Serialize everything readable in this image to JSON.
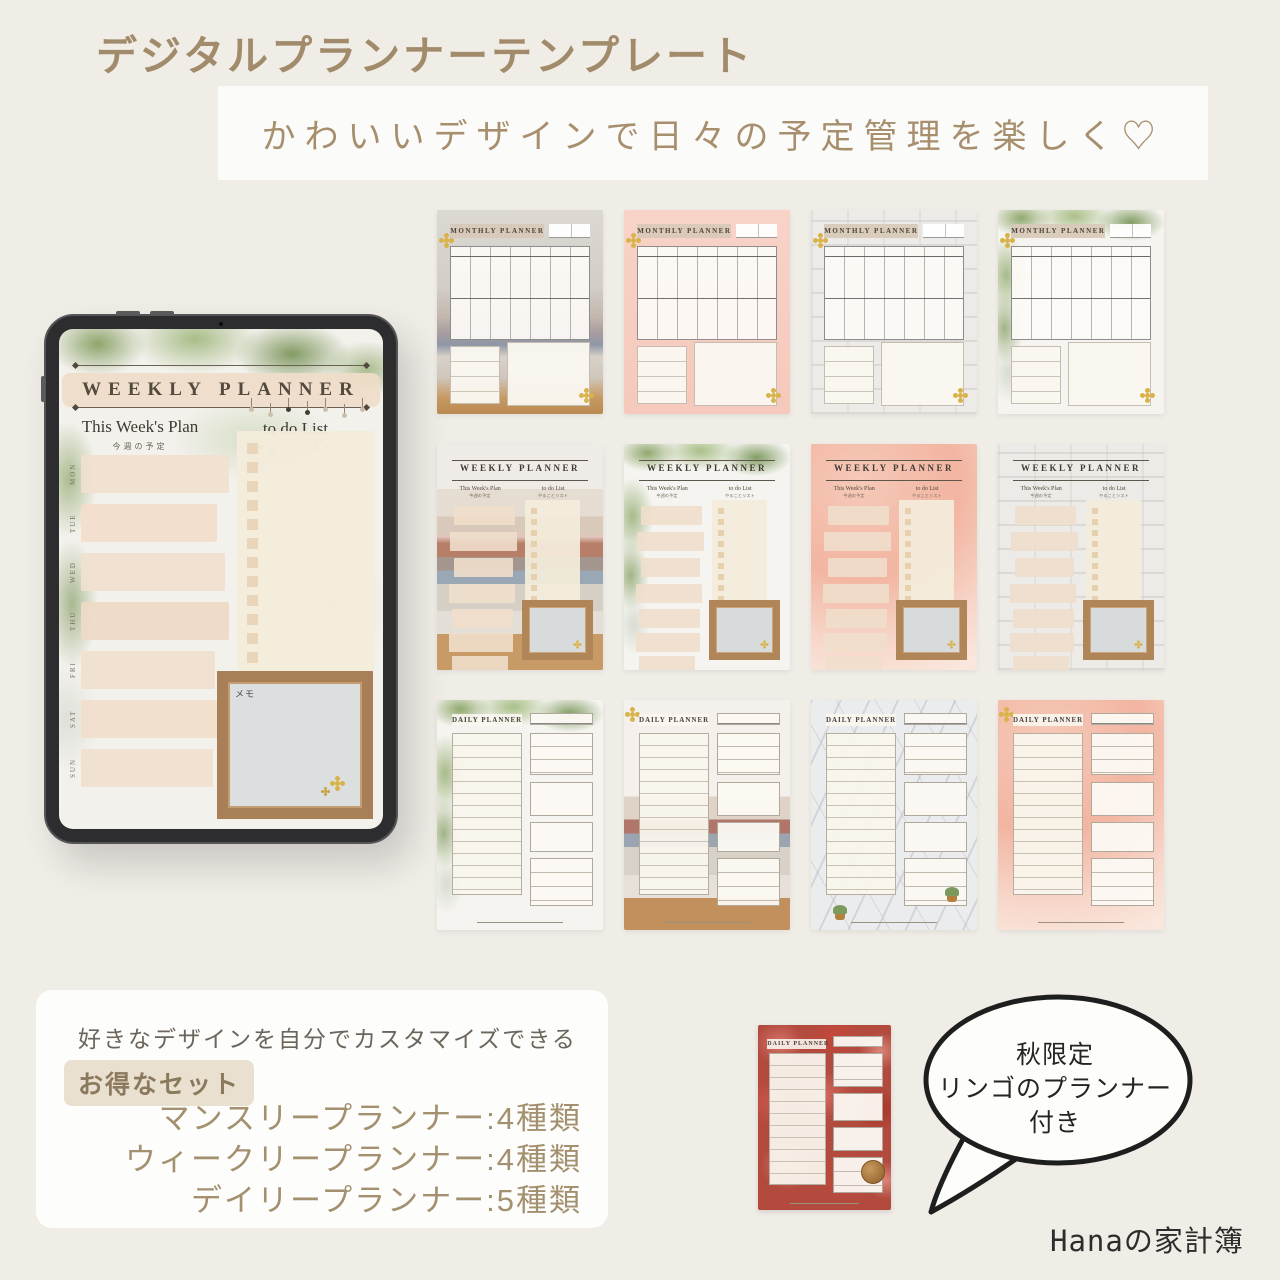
{
  "page": {
    "title": "デジタルプランナーテンプレート",
    "banner": "かわいいデザインで日々の予定管理を楽しく♡",
    "credit": "Hanaの家計簿",
    "colors": {
      "background": "#f0ede7",
      "accent_text": "#a18b6b",
      "banner_bg": "#fbfbf9",
      "beige_box": "#efdecb",
      "wood_frame": "#a97f57",
      "dark_text": "#2d2d2d"
    }
  },
  "labels": {
    "weekly_title": "WEEKLY PLANNER",
    "monthly_title": "MONTHLY PLANNER",
    "daily_title": "DAILY PLANNER",
    "this_weeks_plan": "This Week's Plan",
    "this_weeks_plan_jp": "今週の予定",
    "todo_list": "to do List",
    "todo_list_jp": "やることリスト",
    "memo": "メモ"
  },
  "tablet": {
    "days": [
      "MON",
      "TUE",
      "WED",
      "THU",
      "FRI",
      "SAT",
      "SUN"
    ]
  },
  "grid": {
    "items": [
      {
        "title": "MONTHLY PLANNER",
        "style": "photo-blankets"
      },
      {
        "title": "MONTHLY PLANNER",
        "style": "pink"
      },
      {
        "title": "MONTHLY PLANNER",
        "style": "white-brick"
      },
      {
        "title": "MONTHLY PLANNER",
        "style": "greenery"
      },
      {
        "title": "WEEKLY PLANNER",
        "style": "blanket-stack"
      },
      {
        "title": "WEEKLY PLANNER",
        "style": "greenery"
      },
      {
        "title": "WEEKLY PLANNER",
        "style": "pink-watercolor"
      },
      {
        "title": "WEEKLY PLANNER",
        "style": "white-brick"
      },
      {
        "title": "DAILY PLANNER",
        "style": "greenery"
      },
      {
        "title": "DAILY PLANNER",
        "style": "flowers-blanket"
      },
      {
        "title": "DAILY PLANNER",
        "style": "marble-plants"
      },
      {
        "title": "DAILY PLANNER",
        "style": "pink-watercolor"
      }
    ]
  },
  "info_box": {
    "line1": "好きなデザインを自分でカスタマイズできる",
    "badge": "お得なセット",
    "items": [
      "マンスリープランナー:4種類",
      "ウィークリープランナー:4種類",
      "デイリープランナー:5種類"
    ]
  },
  "bonus": {
    "bubble_line1": "秋限定",
    "bubble_line2": "リンゴのプランナー付き",
    "planner_title": "DAILY PLANNER",
    "style": "apples"
  }
}
